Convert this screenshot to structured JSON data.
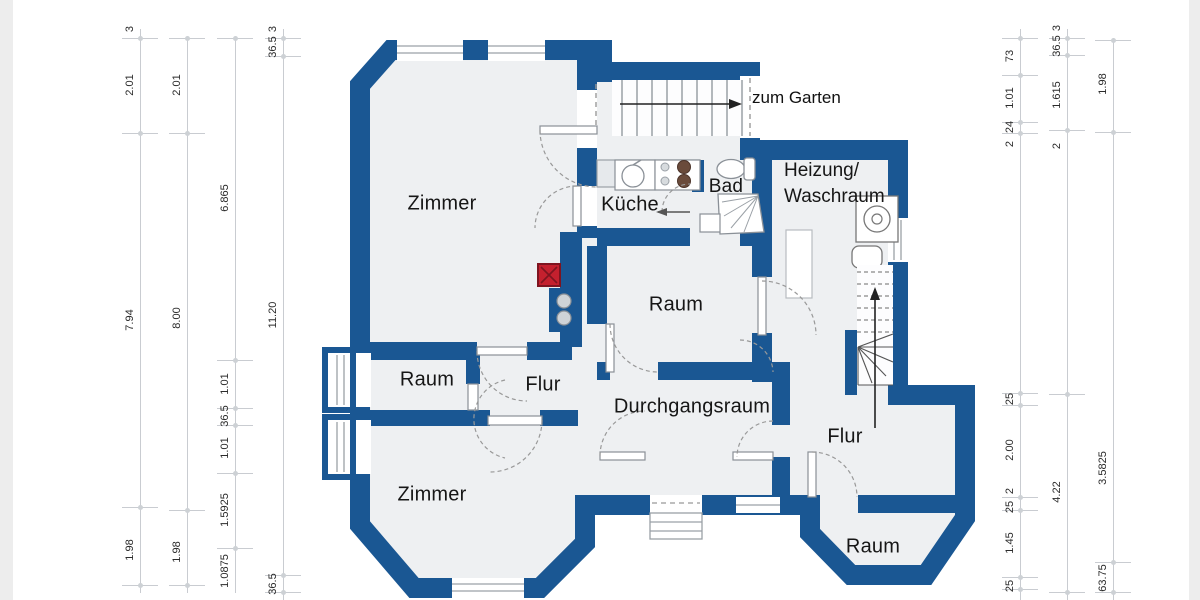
{
  "colors": {
    "wall": "#1a5793",
    "floor": "#eef0f2",
    "chimney_red": "#c4202e",
    "dim_line": "#c9ccd1",
    "dim_text": "#2b2b2b",
    "label_text": "#161616"
  },
  "labels": {
    "zum_garten": "zum Garten",
    "zimmer_top": "Zimmer",
    "kueche": "Küche",
    "bad": "Bad",
    "heizung_line1": "Heizung/",
    "heizung_line2": "Waschraum",
    "raum_center": "Raum",
    "raum_left": "Raum",
    "flur_left": "Flur",
    "durchgangsraum": "Durchgangsraum",
    "zimmer_bottom": "Zimmer",
    "flur_right": "Flur",
    "raum_bottom": "Raum"
  },
  "dimensions": {
    "left_columns": [
      {
        "values": [
          "3",
          "2.01",
          "7.94",
          "1.98"
        ]
      },
      {
        "values": [
          "2.01",
          "8.00",
          "1.98"
        ]
      },
      {
        "values": [
          "6.865",
          "1.01",
          "36.5",
          "1.01",
          "1.5925",
          "1.0875"
        ]
      },
      {
        "values": [
          "3",
          "36.5",
          "11.20",
          "36.5"
        ]
      }
    ],
    "right_columns": [
      {
        "values": [
          "73",
          "1.01",
          "24",
          "2",
          "25",
          "2.00",
          "2",
          "25",
          "1.45",
          "25"
        ]
      },
      {
        "values": [
          "3",
          "36.5",
          "1.615",
          "2",
          "4.22"
        ]
      },
      {
        "values": [
          "1.98",
          "3.5825",
          "63.75"
        ]
      }
    ]
  }
}
